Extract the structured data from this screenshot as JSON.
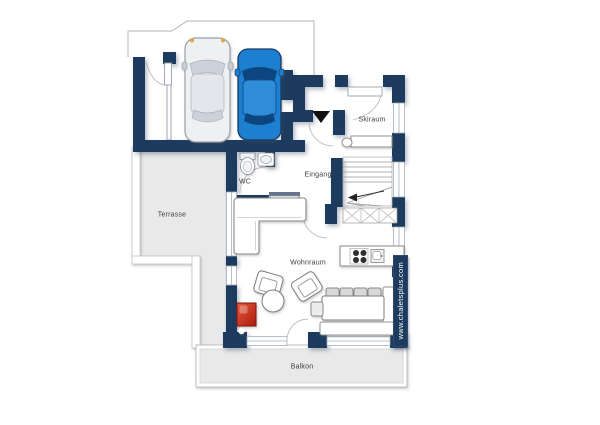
{
  "plan": {
    "title": "chalet-ground-floor-plan",
    "rooms": [
      {
        "id": "terrasse",
        "label": "Terrasse"
      },
      {
        "id": "wc",
        "label": "WC"
      },
      {
        "id": "eingang",
        "label": "Eingang"
      },
      {
        "id": "skiraum",
        "label": "Skiraum"
      },
      {
        "id": "wohnraum",
        "label": "Wohnraum"
      },
      {
        "id": "balkon",
        "label": "Balkon"
      }
    ],
    "watermark": "www.chaletsplus.com",
    "colors": {
      "wall": "#1d3b5e",
      "outdoor_floor": "#e9e9e9",
      "car_blue": "#1d7fd0",
      "car_silver": "#eef0f2",
      "fireplace_red": "#cf3a22",
      "background": "#ffffff"
    },
    "features": [
      "silver-car",
      "blue-car",
      "carport",
      "entrance-marker",
      "winder-staircase",
      "wardrobe",
      "l-sofa",
      "armchairs",
      "round-table",
      "fireplace",
      "dining-table",
      "corner-bench",
      "kitchen-counter",
      "stove",
      "kitchen-sink",
      "toilet",
      "wash-basin",
      "ski-bench",
      "balcony-railing",
      "terrace-edge"
    ]
  }
}
